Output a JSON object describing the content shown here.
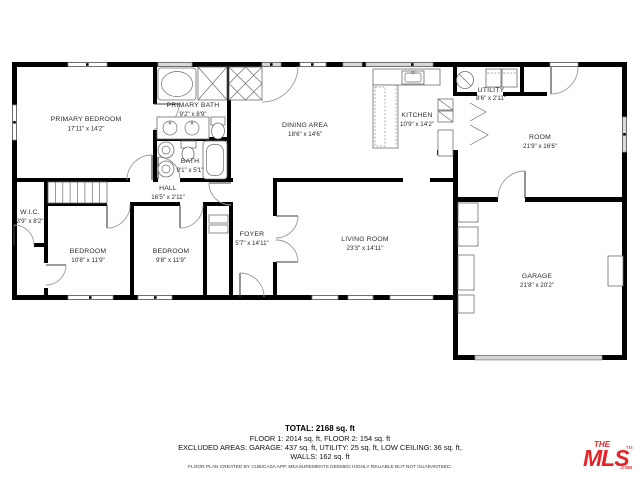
{
  "plan": {
    "rooms": [
      {
        "name": "PRIMARY BEDROOM",
        "dims": "17'11\" x 14'2\""
      },
      {
        "name": "PRIMARY BATH",
        "dims": "9'2\" x 8'9\""
      },
      {
        "name": "BATH",
        "dims": "9'1\" x 5'1\""
      },
      {
        "name": "HALL",
        "dims": "16'5\" x 2'11\""
      },
      {
        "name": "W.I.C.",
        "dims": "3'9\" x 8'2\""
      },
      {
        "name": "BEDROOM",
        "dims": "10'8\" x 11'9\""
      },
      {
        "name": "BEDROOM",
        "dims": "9'8\" x 11'9\""
      },
      {
        "name": "FOYER",
        "dims": "5'7\" x 14'11\""
      },
      {
        "name": "DINING AREA",
        "dims": "18'6\" x 14'6\""
      },
      {
        "name": "KITCHEN",
        "dims": "10'9\" x 14'2\""
      },
      {
        "name": "UTILITY",
        "dims": "8'6\" x 2'11\""
      },
      {
        "name": "ROOM",
        "dims": "21'9\" x 16'6\""
      },
      {
        "name": "LIVING ROOM",
        "dims": "23'3\" x 14'11\""
      },
      {
        "name": "GARAGE",
        "dims": "21'8\" x 20'2\""
      }
    ]
  },
  "summary": {
    "total": "TOTAL: 2168 sq. ft",
    "floors": "FLOOR 1: 2014 sq. ft, FLOOR 2: 154 sq. ft",
    "excluded": "EXCLUDED AREAS: GARAGE: 437 sq. ft, UTILITY: 25 sq. ft, LOW CEILING: 36 sq. ft,",
    "walls": "WALLS: 162 sq. ft",
    "disclaimer": "FLOOR PLAN CREATED BY CUBICASA APP. MEASUREMENTS DEEMED HIGHLY RELIABLE BUT NOT GUARANTEED."
  },
  "logo": {
    "the": "THE",
    "mls": "MLS",
    "com": ".COM",
    "tm": "TM"
  },
  "colors": {
    "wall": "#000000",
    "window_gray": "#d9d9d9",
    "logo_red": "#e52329"
  }
}
